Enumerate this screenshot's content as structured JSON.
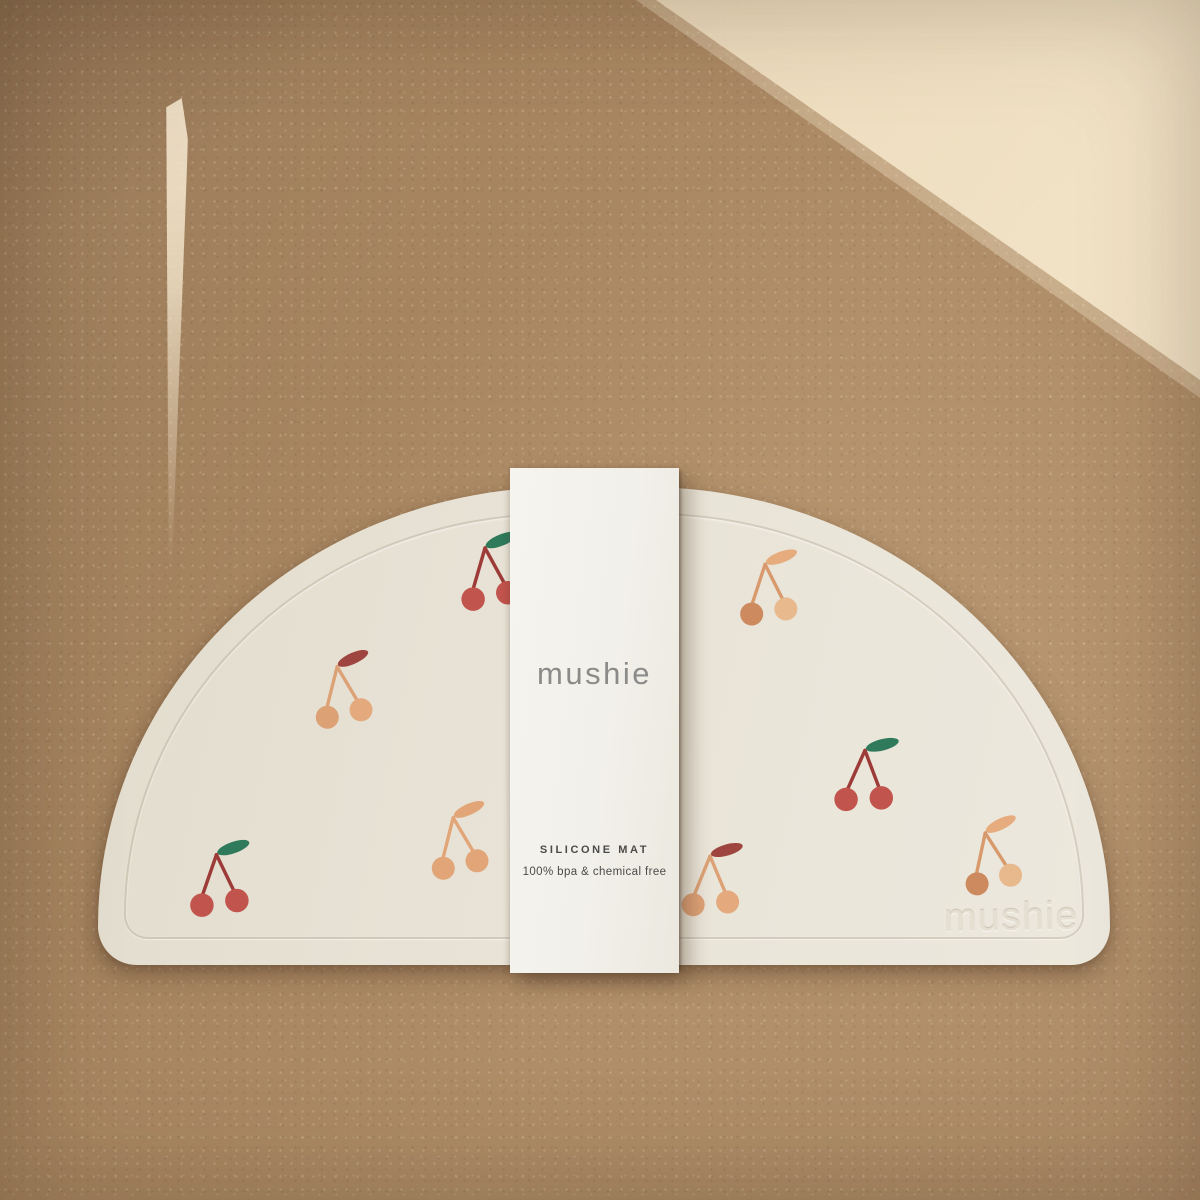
{
  "band": {
    "logo": "mushie",
    "product_name": "SILICONE MAT",
    "tagline": "100% bpa & chemical free"
  },
  "mat": {
    "embossed_logo": "mushie",
    "cherries": [
      {
        "x": 442,
        "y": 527,
        "size": 98,
        "rotation": -8,
        "variant": "red"
      },
      {
        "x": 722,
        "y": 544,
        "size": 96,
        "rotation": -6,
        "variant": "orange_duo"
      },
      {
        "x": 296,
        "y": 646,
        "size": 96,
        "rotation": -10,
        "variant": "peach_red_leaf"
      },
      {
        "x": 818,
        "y": 730,
        "size": 98,
        "rotation": 0,
        "variant": "red"
      },
      {
        "x": 412,
        "y": 797,
        "size": 96,
        "rotation": -10,
        "variant": "peach_mono"
      },
      {
        "x": 172,
        "y": 834,
        "size": 98,
        "rotation": -5,
        "variant": "red"
      },
      {
        "x": 665,
        "y": 836,
        "size": 96,
        "rotation": -2,
        "variant": "peach_red_leaf"
      },
      {
        "x": 945,
        "y": 812,
        "size": 96,
        "rotation": -12,
        "variant": "orange_duo"
      }
    ],
    "variants": {
      "red": {
        "left": "#c1544d",
        "right": "#c1544d",
        "stem": "#9d3b38",
        "leaf": "#2f7a5b"
      },
      "orange_duo": {
        "left": "#cd8a5e",
        "right": "#e9b98e",
        "stem": "#d89a6c",
        "leaf": "#e6ac7e"
      },
      "peach_red_leaf": {
        "left": "#dda176",
        "right": "#e4aa7e",
        "stem": "#dda176",
        "leaf": "#9d453e"
      },
      "peach_mono": {
        "left": "#e2a577",
        "right": "#e2a577",
        "stem": "#e2a577",
        "leaf": "#e2a577"
      }
    }
  },
  "colors": {
    "background_cardboard": "#aa8865",
    "background_sunlit": "#ecd9b8",
    "mat_surface": "#e9e4d8",
    "band_paper": "#f3f1ea",
    "logo_gray": "#8b8b89",
    "label_dark": "#4b4b49",
    "embossed": "#e5dfd2"
  }
}
